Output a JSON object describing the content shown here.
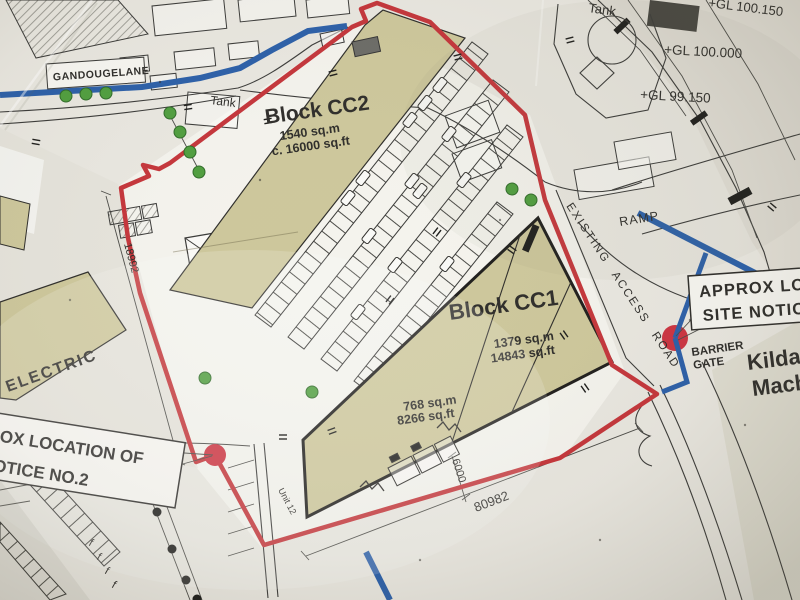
{
  "labels": {
    "street": "GANDOUGELANE",
    "tank_left": "Tank",
    "tank_right": "Tank",
    "ramp": "RAMP",
    "access_road": "EXISTING ACCESS ROAD",
    "electric": "ELECTRIC",
    "unit": "Unit 12",
    "approx_line1": "APPROX LOC",
    "approx_line2": "SITE NOTICE",
    "notice_line1": "OX LOCATION OF",
    "notice_line2": "OTICE NO.2",
    "barrier_line1": "BARRIER",
    "barrier_line2": "GATE",
    "kildare_line1": "Kilda",
    "kildare_line2": "Mach"
  },
  "blocks": {
    "cc2": {
      "name": "Block CC2",
      "area_metric": "1540 sq.m",
      "area_imperial": "c. 16000 sq.ft"
    },
    "cc1": {
      "name": "Block CC1",
      "area_metric": "1379 sq.m",
      "area_imperial": "14843 sq.ft"
    },
    "cc1_sub": {
      "area_metric": "768 sq.m",
      "area_imperial": "8266 sq.ft"
    }
  },
  "levels": {
    "gl1": "+GL 100.000",
    "gl2": "+GL 99.150",
    "gl3": "+GL 100.150"
  },
  "dimensions": {
    "left": "18992",
    "bottom": "80982",
    "small": "6000"
  },
  "colors": {
    "paper": "#e9e7e0",
    "boundary": "#c4353a",
    "marker": "#cc3340",
    "water": "#2b5fa8",
    "building": "#cdc79b",
    "tree": "#4f9e3e",
    "ink": "#2e2d2a"
  }
}
